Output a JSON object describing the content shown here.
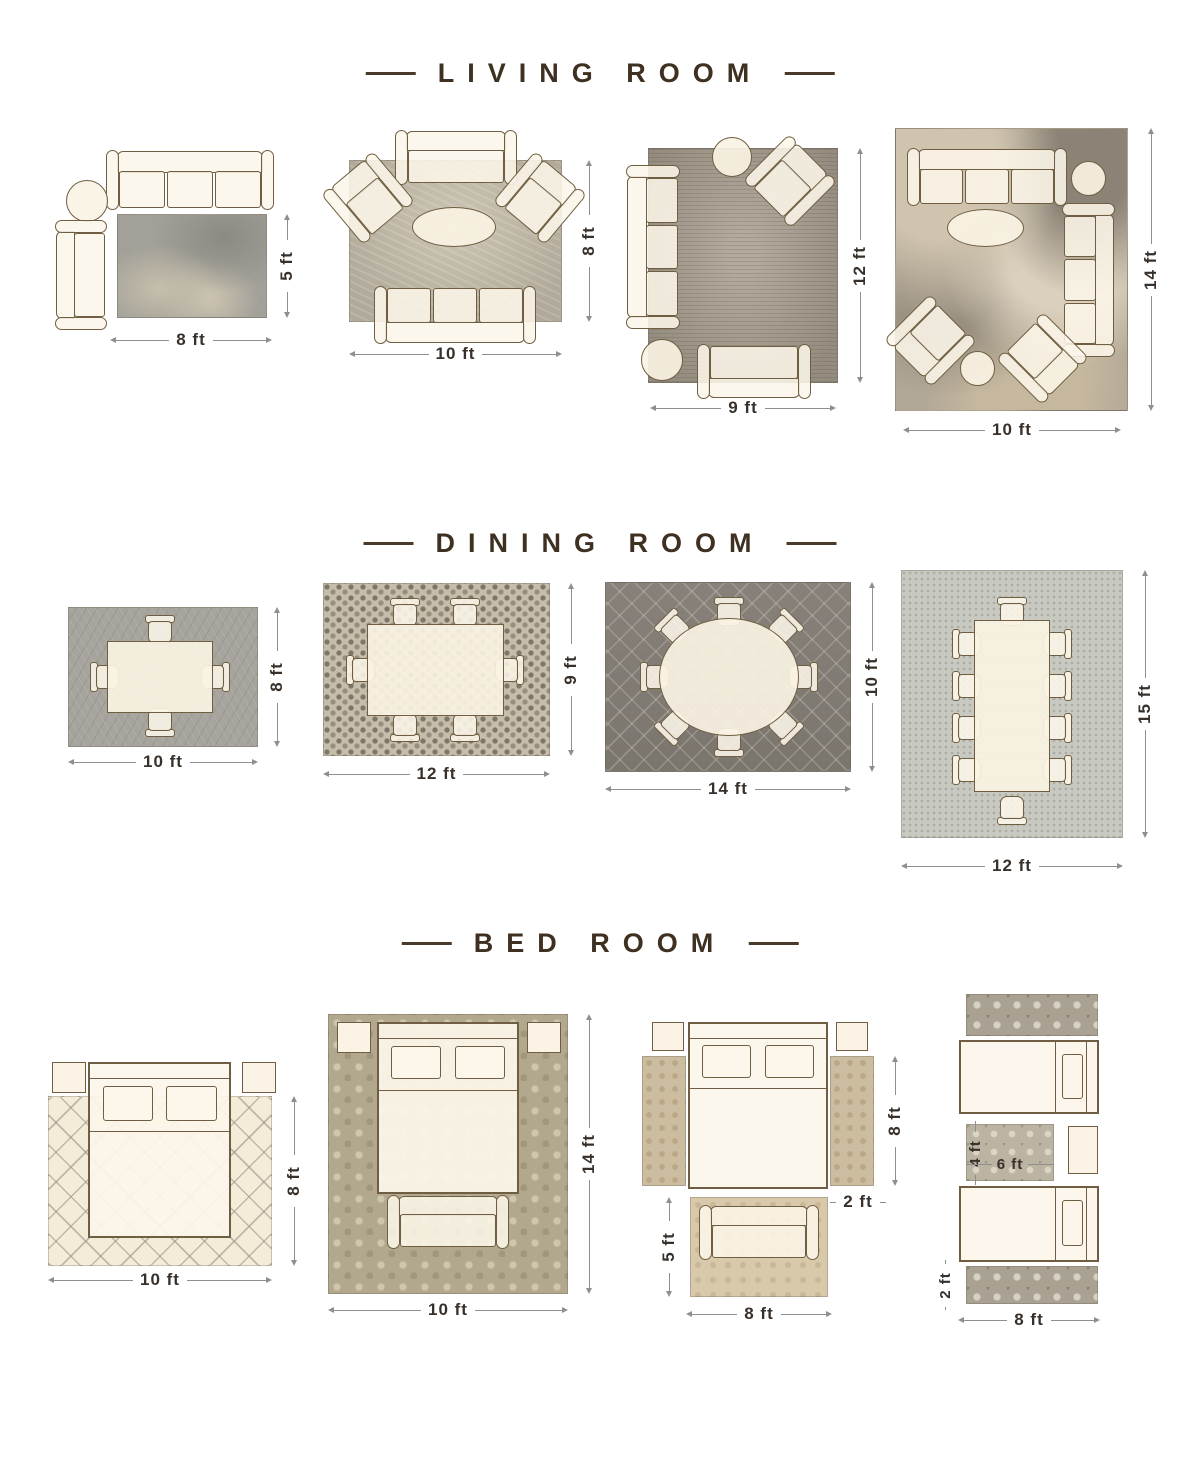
{
  "titles": {
    "living_room": "LIVING ROOM",
    "dining_room": "DINING ROOM",
    "bed_room": "BED ROOM"
  },
  "living_room": {
    "layout1": {
      "rug_width": "8 ft",
      "rug_height": "5 ft"
    },
    "layout2": {
      "rug_width": "10 ft",
      "rug_height": "8 ft"
    },
    "layout3": {
      "rug_width": "9 ft",
      "rug_height": "12 ft"
    },
    "layout4": {
      "rug_width": "10 ft",
      "rug_height": "14 ft"
    }
  },
  "dining_room": {
    "layout1": {
      "rug_width": "10 ft",
      "rug_height": "8 ft"
    },
    "layout2": {
      "rug_width": "12 ft",
      "rug_height": "9 ft"
    },
    "layout3": {
      "rug_width": "14 ft",
      "rug_height": "10 ft"
    },
    "layout4": {
      "rug_width": "12 ft",
      "rug_height": "15 ft"
    }
  },
  "bed_room": {
    "layout1": {
      "rug_width": "10 ft",
      "rug_height": "8 ft"
    },
    "layout2": {
      "rug_width": "10 ft",
      "rug_height": "14 ft"
    },
    "layout3": {
      "runner_height": "8 ft",
      "runner_width": "2 ft",
      "foot_rug_height": "5 ft",
      "foot_rug_width": "8 ft"
    },
    "layout4": {
      "small_rug_height": "4 ft",
      "small_rug_width": "6 ft",
      "runner_height": "2 ft",
      "runner_width": "8 ft"
    }
  },
  "colors": {
    "title": "#3f3122",
    "furniture_outline": "#6f5e41",
    "dimension_text": "#38302a",
    "dimension_line": "#8f8f8f",
    "background": "#ffffff"
  }
}
